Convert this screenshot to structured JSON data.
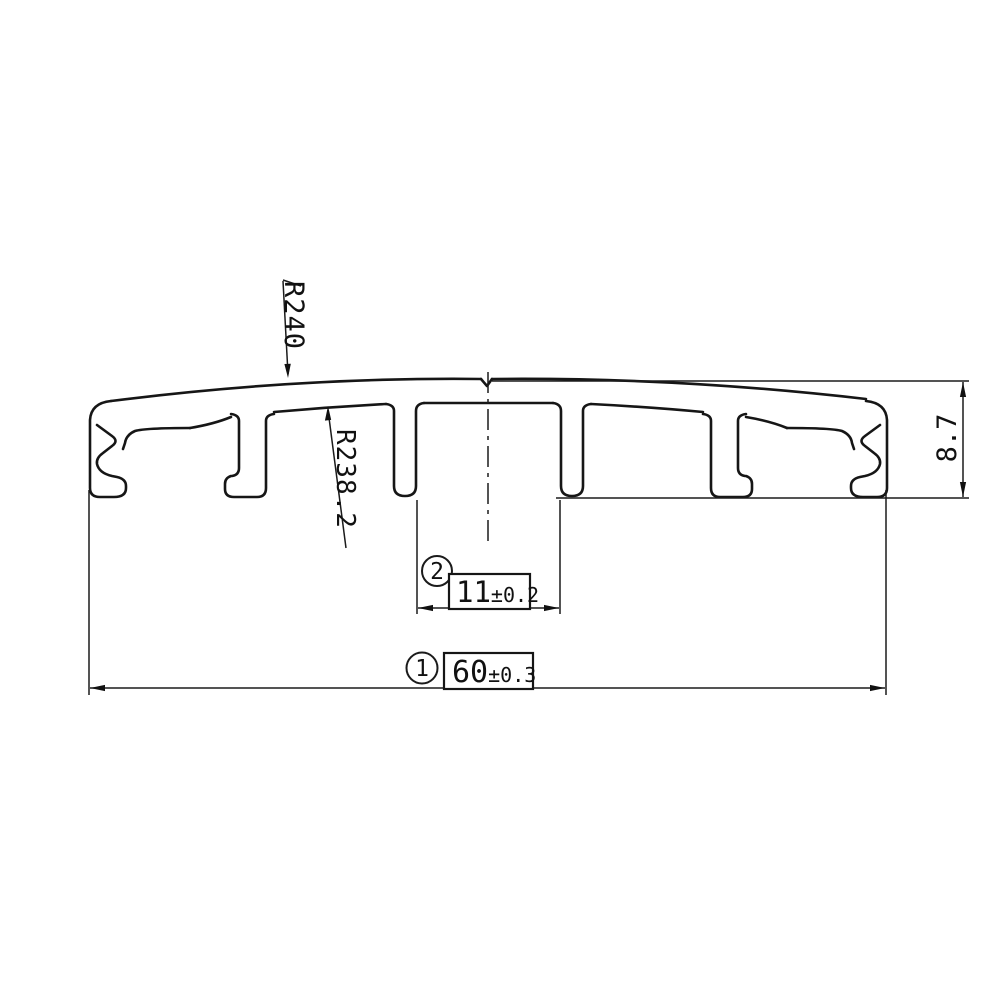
{
  "drawing": {
    "type": "technical-profile-cross-section",
    "colors": {
      "line": "#161616",
      "background": "#ffffff"
    },
    "dims": {
      "radius_outer": {
        "label": "R240"
      },
      "radius_inner": {
        "label": "R238.2"
      },
      "height": {
        "label": "8.7"
      },
      "slot_width": {
        "balloon": "2",
        "value": "11",
        "tolerance": "±0.2"
      },
      "overall_width": {
        "balloon": "1",
        "value": "60",
        "tolerance": "±0.3"
      }
    }
  }
}
